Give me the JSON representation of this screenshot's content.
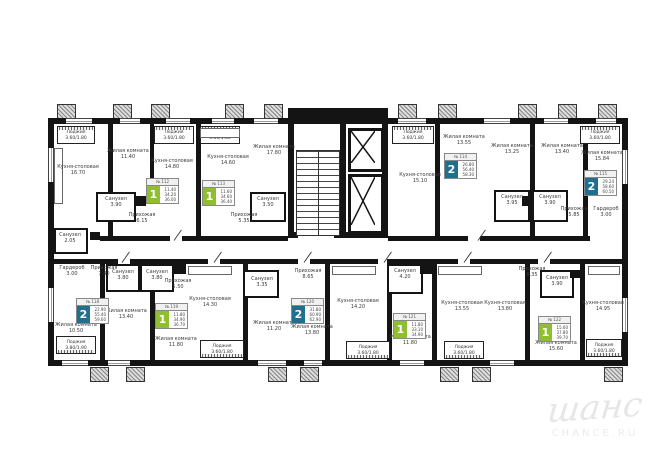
{
  "watermark": {
    "script": "шанс",
    "caption": "CHANCE.RU"
  },
  "colors": {
    "badge_green": "#8fbf2f",
    "badge_blue": "#1f6f8f",
    "wall": "#141414"
  },
  "rooms": [
    {
      "name": "Кухня-столовая",
      "area": "16.70"
    },
    {
      "name": "Жилая комната",
      "area": "11.40"
    },
    {
      "name": "Кухня-столовая",
      "area": "14.80"
    },
    {
      "name": "Санузел",
      "area": "3.90"
    },
    {
      "name": "Прихожая",
      "area": "6.15"
    },
    {
      "name": "Кухня-столовая",
      "area": "14.60"
    },
    {
      "name": "Жилая комната",
      "area": "17.80"
    },
    {
      "name": "Санузел",
      "area": "3.50"
    },
    {
      "name": "Прихожая",
      "area": "5.35"
    },
    {
      "name": "Кухня-столовая",
      "area": "15.10"
    },
    {
      "name": "Жилая комната",
      "area": "13.55"
    },
    {
      "name": "Жилая комната",
      "area": "13.25"
    },
    {
      "name": "Санузел",
      "area": "3.95"
    },
    {
      "name": "Жилая комната",
      "area": "13.40"
    },
    {
      "name": "Санузел",
      "area": "3.90"
    },
    {
      "name": "Прихожая",
      "area": "5.85"
    },
    {
      "name": "Гардероб",
      "area": "3.00"
    },
    {
      "name": "Жилая комната",
      "area": "15.84"
    },
    {
      "name": "Гардероб",
      "area": "3.00"
    },
    {
      "name": "Прихожая",
      "area": "7.40"
    },
    {
      "name": "Санузел",
      "area": "2.05"
    },
    {
      "name": "Жилая комната",
      "area": "10.50"
    },
    {
      "name": "Жилая комната",
      "area": "13.40"
    },
    {
      "name": "Санузел",
      "area": "3.80"
    },
    {
      "name": "Санузел",
      "area": "3.80"
    },
    {
      "name": "Прихожая",
      "area": "5.50"
    },
    {
      "name": "Кухня-столовая",
      "area": "14.30"
    },
    {
      "name": "Жилая комната",
      "area": "11.80"
    },
    {
      "name": "Жилая комната",
      "area": "11.20"
    },
    {
      "name": "Санузел",
      "area": "3.35"
    },
    {
      "name": "Прихожая",
      "area": "8.65"
    },
    {
      "name": "Жилая комната",
      "area": "13.80"
    },
    {
      "name": "Кухня-столовая",
      "area": "14.20"
    },
    {
      "name": "Санузел",
      "area": "4.20"
    },
    {
      "name": "Жилая комната",
      "area": "11.80"
    },
    {
      "name": "Кухня-столовая",
      "area": "13.55"
    },
    {
      "name": "Прихожая",
      "area": "6.35"
    },
    {
      "name": "Кухня-столовая",
      "area": "13.80"
    },
    {
      "name": "Санузел",
      "area": "3.90"
    },
    {
      "name": "Жилая комната",
      "area": "15.60"
    },
    {
      "name": "Кухня-столовая",
      "area": "14.95"
    }
  ],
  "loggias": [
    {
      "name": "Лоджия",
      "dims": "3.60/1.80"
    },
    {
      "name": "Лоджия",
      "dims": "3.60/1.80"
    },
    {
      "name": "Лоджия",
      "dims": "3.60/1.80"
    },
    {
      "name": "Лоджия",
      "dims": "3.60/1.80"
    },
    {
      "name": "Лоджия",
      "dims": "3.60/1.80"
    },
    {
      "name": "Лоджия",
      "dims": "3.60/1.80"
    },
    {
      "name": "Лоджия",
      "dims": "3.60/1.80"
    },
    {
      "name": "Лоджия",
      "dims": "3.60/1.80"
    },
    {
      "name": "Лоджия",
      "dims": "3.60/1.80"
    },
    {
      "name": "Лоджия",
      "dims": "3.80/1.90"
    }
  ],
  "badges": [
    {
      "no": "№ 112",
      "type": "1",
      "vals": [
        "11.40",
        "34.20",
        "36.00"
      ]
    },
    {
      "no": "№ 113",
      "type": "1",
      "vals": [
        "11.60",
        "34.60",
        "36.40"
      ]
    },
    {
      "no": "№ 114",
      "type": "2",
      "vals": [
        "26.80",
        "56.40",
        "58.30"
      ]
    },
    {
      "no": "№ 115",
      "type": "2",
      "vals": [
        "29.24",
        "58.60",
        "60.50"
      ]
    },
    {
      "no": "№ 118",
      "type": "2",
      "vals": [
        "22.90",
        "55.40",
        "59.60"
      ]
    },
    {
      "no": "№ 119",
      "type": "1",
      "vals": [
        "11.80",
        "34.90",
        "36.70"
      ]
    },
    {
      "no": "№ 120",
      "type": "2",
      "vals": [
        "31.80",
        "60.90",
        "62.90"
      ]
    },
    {
      "no": "№ 121",
      "type": "1",
      "vals": [
        "11.80",
        "33.10",
        "34.90"
      ]
    },
    {
      "no": "№ 122",
      "type": "1",
      "vals": [
        "15.60",
        "37.80",
        "39.70"
      ]
    }
  ]
}
